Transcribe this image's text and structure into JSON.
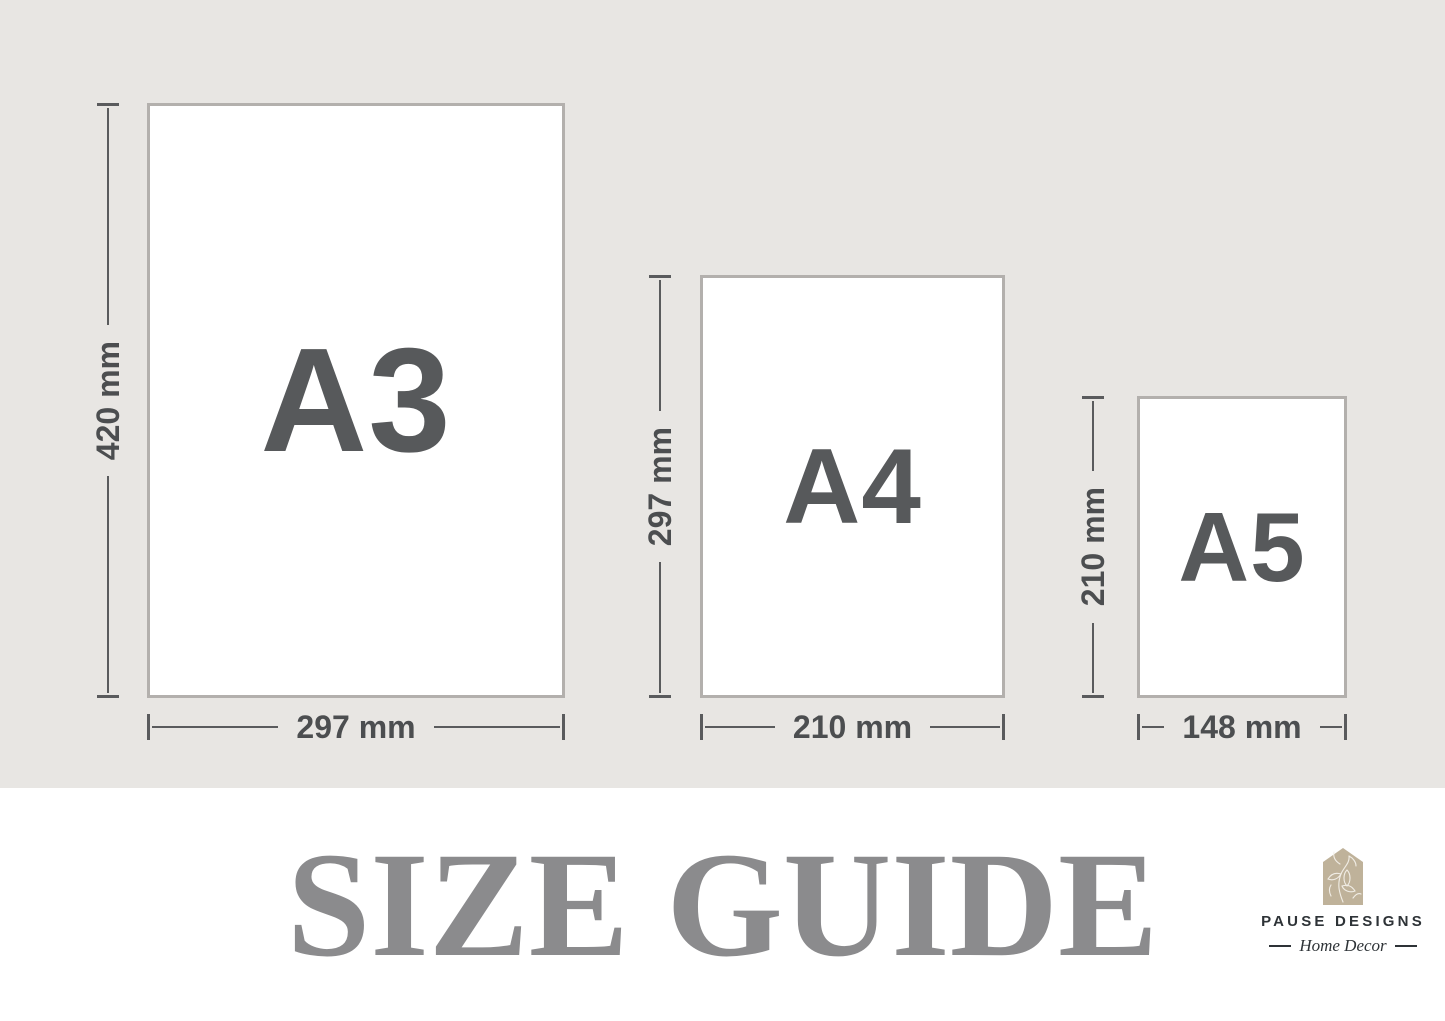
{
  "papers": [
    {
      "id": "a3",
      "label": "A3",
      "height_label": "420 mm",
      "width_label": "297 mm"
    },
    {
      "id": "a4",
      "label": "A4",
      "height_label": "297 mm",
      "width_label": "210 mm"
    },
    {
      "id": "a5",
      "label": "A5",
      "height_label": "210 mm",
      "width_label": "148 mm"
    }
  ],
  "footer": {
    "title": "SIZE GUIDE",
    "brand_name": "PAUSE DESIGNS",
    "brand_tagline": "Home Decor"
  },
  "icons": {
    "house_floral": "house-floral-icon"
  },
  "colors": {
    "diagram_background": "#e8e6e3",
    "paper_fill": "#ffffff",
    "paper_border": "#b3b0ad",
    "dimension_line": "#5a5b5d",
    "dimension_text": "#4c4e50",
    "paper_label_text": "#57595b",
    "title_text": "#8b8b8d",
    "brand_text": "#2e3337",
    "brand_house_tan": "#bfb29a"
  }
}
